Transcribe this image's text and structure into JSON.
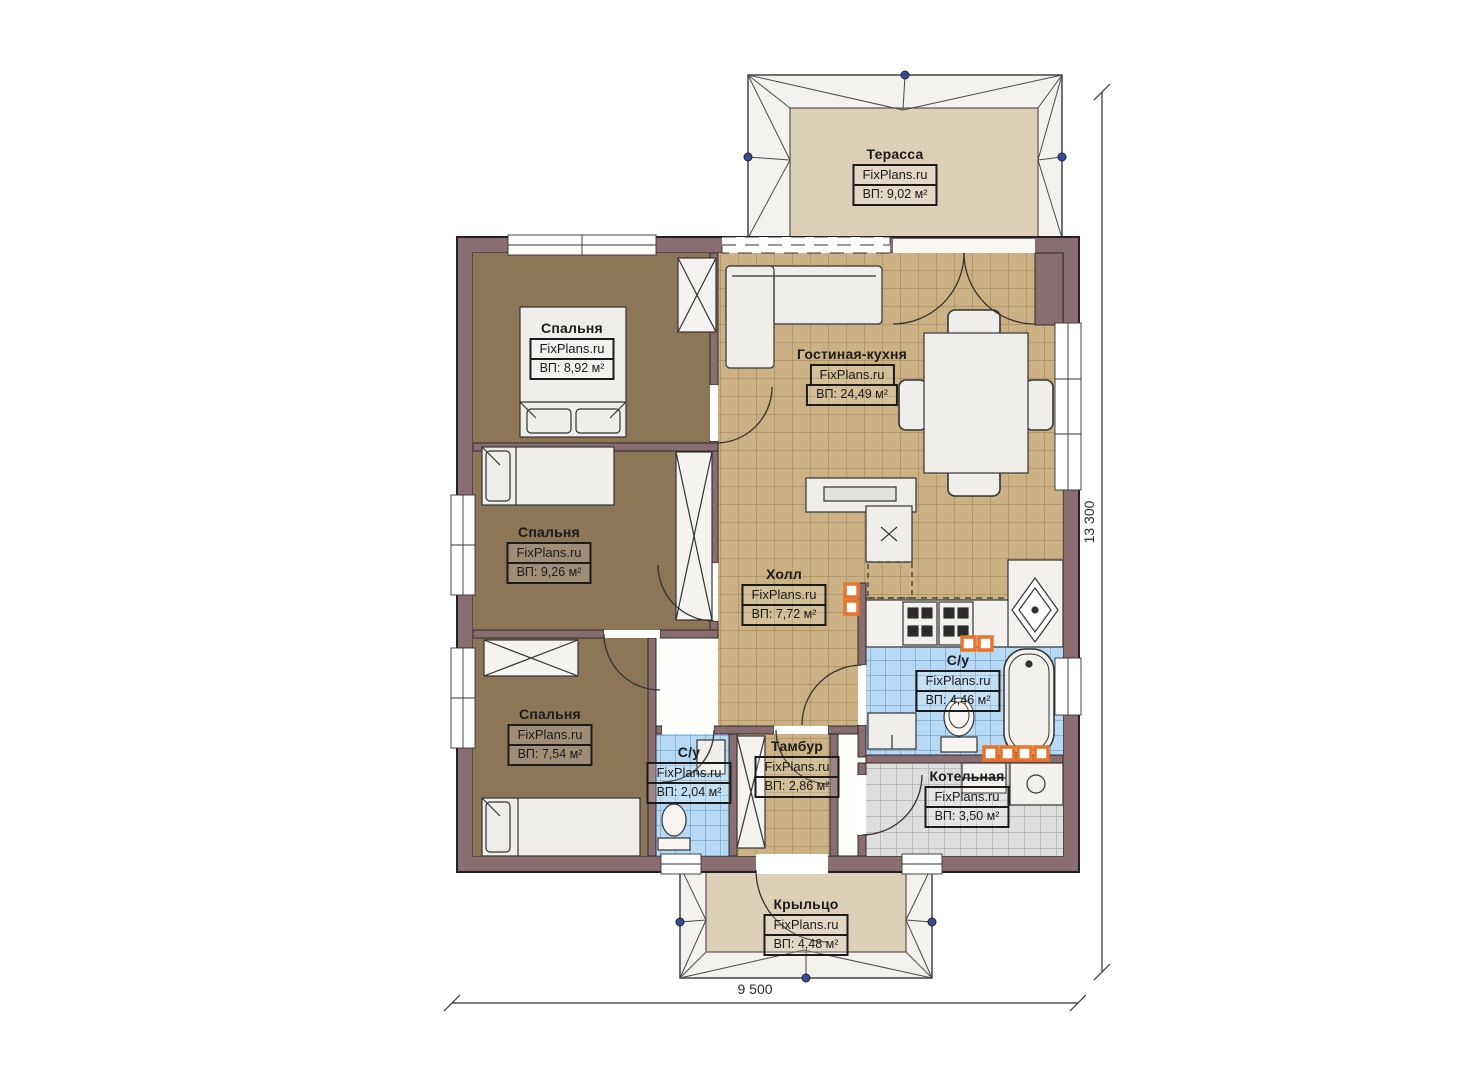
{
  "plan": {
    "rooms": [
      {
        "id": "terrace",
        "name": "Терасса",
        "brand": "FixPlans.ru",
        "area": "ВП: 9,02 м²"
      },
      {
        "id": "bedroom-1",
        "name": "Спальня",
        "brand": "FixPlans.ru",
        "area": "ВП: 8,92 м²"
      },
      {
        "id": "living-kitchen",
        "name": "Гостиная-кухня",
        "brand": "FixPlans.ru",
        "area": "ВП: 24,49 м²"
      },
      {
        "id": "bedroom-2",
        "name": "Спальня",
        "brand": "FixPlans.ru",
        "area": "ВП: 9,26 м²"
      },
      {
        "id": "hall",
        "name": "Холл",
        "brand": "FixPlans.ru",
        "area": "ВП: 7,72 м²"
      },
      {
        "id": "bathroom-main",
        "name": "С/у",
        "brand": "FixPlans.ru",
        "area": "ВП: 4,46 м²"
      },
      {
        "id": "bedroom-3",
        "name": "Спальня",
        "brand": "FixPlans.ru",
        "area": "ВП: 7,54 м²"
      },
      {
        "id": "bathroom-small",
        "name": "С/у",
        "brand": "FixPlans.ru",
        "area": "ВП: 2,04 м²"
      },
      {
        "id": "vestibule",
        "name": "Тамбур",
        "brand": "FixPlans.ru",
        "area": "ВП: 2,86 м²"
      },
      {
        "id": "boiler-room",
        "name": "Котельная",
        "brand": "FixPlans.ru",
        "area": "ВП: 3,50 м²"
      },
      {
        "id": "porch",
        "name": "Крыльцо",
        "brand": "FixPlans.ru",
        "area": "ВП: 4,48 м²"
      }
    ],
    "dimensions": {
      "width_label": "9 500",
      "height_label": "13 300"
    },
    "colors": {
      "wall": "#8a6d70",
      "bedroom_floor": "#8d7557",
      "tile_beige": "#cbb183",
      "tile_blue": "#b7d9f3",
      "tile_gray": "#dedede",
      "terrace_floor": "#ddd0b7",
      "radiator_accent": "#e8732a"
    }
  }
}
